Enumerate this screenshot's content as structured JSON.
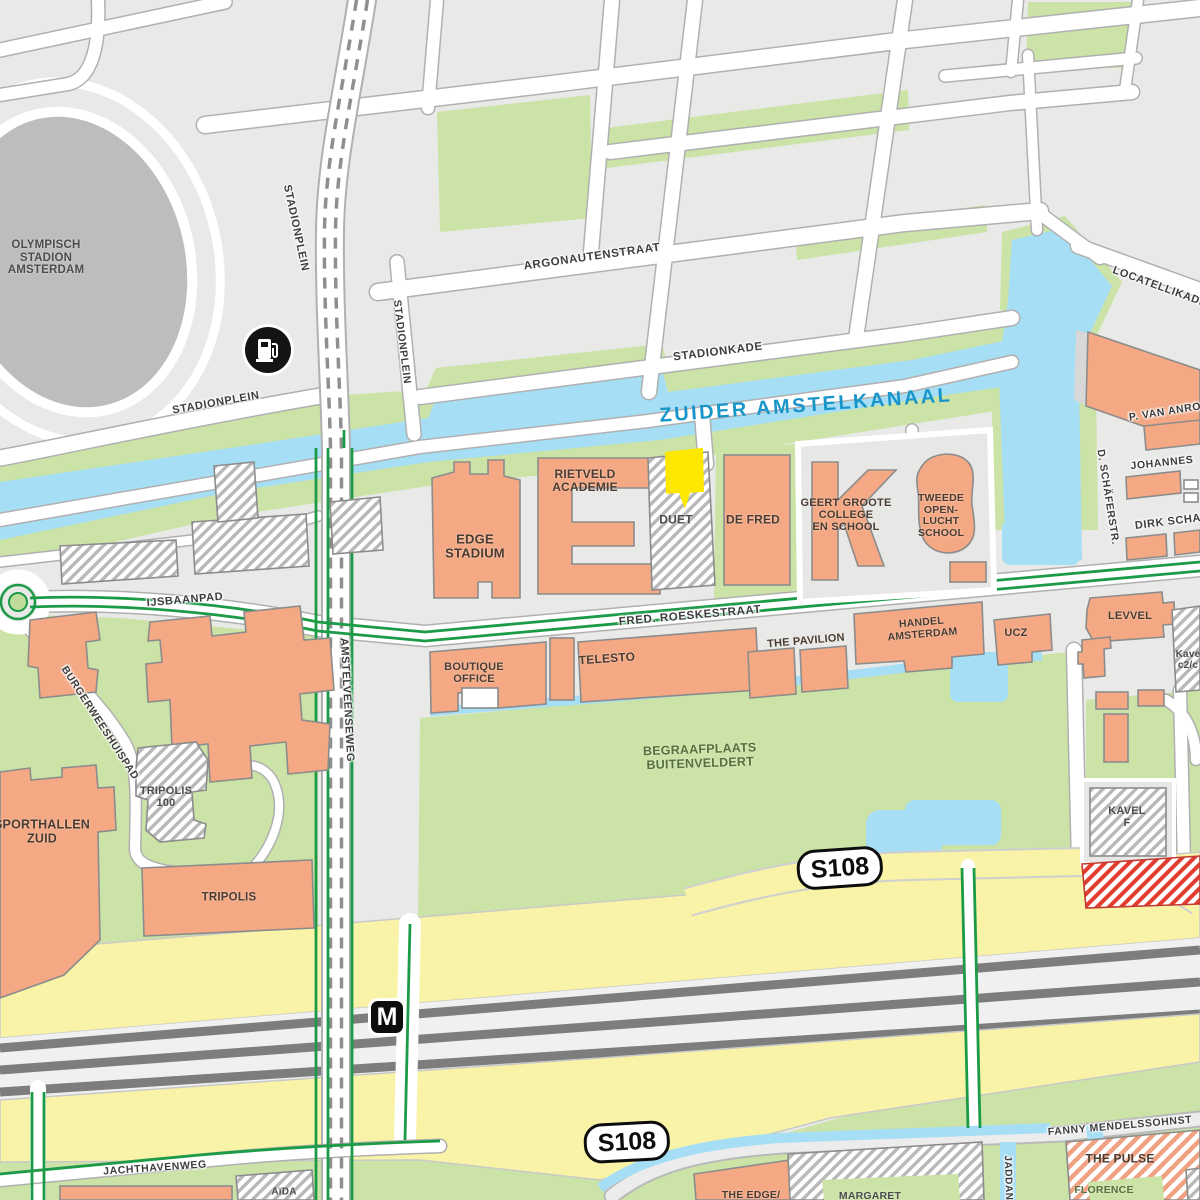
{
  "colors": {
    "block_gray": "#e9e9e7",
    "water": "#a6def5",
    "water_label": "#1895c9",
    "green": "#cbe3a6",
    "building_orange": "#f4a884",
    "hatch_stripe": "#b8b8b8",
    "red_hatch": "#e23d32",
    "road_yellow": "#f8f3a6",
    "rail_dark": "#7d7d7d",
    "route_green": "#1c9b47",
    "marker_yellow": "#ffe800",
    "stadium_gray": "#bdbdbd"
  },
  "street_labels": [
    {
      "id": "stadionplein-north",
      "text": "STADIONPLEIN",
      "x": 296,
      "y": 228,
      "rot": 78,
      "size": 11
    },
    {
      "id": "stadionplein-mid",
      "text": "STADIONPLEIN",
      "x": 402,
      "y": 342,
      "rot": 83,
      "size": 10.5
    },
    {
      "id": "stadionplein-curve",
      "text": "STADIONPLEIN",
      "x": 216,
      "y": 403,
      "rot": -10,
      "size": 11
    },
    {
      "id": "argonautenstraat",
      "text": "ARGONAUTENSTRAAT",
      "x": 592,
      "y": 257,
      "rot": -8,
      "size": 11.5
    },
    {
      "id": "stadionkade",
      "text": "STADIONKADE",
      "x": 718,
      "y": 352,
      "rot": -7,
      "size": 11.5
    },
    {
      "id": "zuider-amstelkanaal",
      "text": "ZUIDER AMSTELKANAAL",
      "x": 806,
      "y": 406,
      "rot": -4,
      "variant": "water"
    },
    {
      "id": "locatellikade",
      "text": "LOCATELLIKADE",
      "x": 1160,
      "y": 287,
      "rot": 20,
      "size": 11
    },
    {
      "id": "p-van-anrooy",
      "text": "P. VAN ANRO",
      "x": 1165,
      "y": 412,
      "rot": -9,
      "size": 10.5
    },
    {
      "id": "johannes",
      "text": "JOHANNES",
      "x": 1162,
      "y": 463,
      "rot": -6,
      "size": 10.5
    },
    {
      "id": "d-schaferstr",
      "text": "D. SCHÄFERSTR.",
      "x": 1108,
      "y": 497,
      "rot": 81,
      "size": 10.5
    },
    {
      "id": "dirk-scha",
      "text": "DIRK SCHA",
      "x": 1168,
      "y": 522,
      "rot": -7,
      "size": 11
    },
    {
      "id": "ijsbaanpad",
      "text": "IJSBAANPAD",
      "x": 185,
      "y": 600,
      "rot": -5,
      "size": 11
    },
    {
      "id": "fred-roeskestraat",
      "text": "FRED. ROESKESTRAAT",
      "x": 690,
      "y": 616,
      "rot": -5,
      "size": 11.5
    },
    {
      "id": "amstelveenseweg",
      "text": "AMSTELVEENSEWEG",
      "x": 347,
      "y": 700,
      "rot": 87,
      "size": 11
    },
    {
      "id": "burgerweeshuispad",
      "text": "BURGERWEESHUISPAD",
      "x": 100,
      "y": 723,
      "rot": 57,
      "size": 10.5
    },
    {
      "id": "jachthavenweg",
      "text": "JACHTHAVENWEG",
      "x": 155,
      "y": 1168,
      "rot": -4,
      "size": 10.5
    },
    {
      "id": "fanny-mendelssohnstraat",
      "text": "FANNY MENDELSSOHNST",
      "x": 1120,
      "y": 1126,
      "rot": -5,
      "size": 10.5
    },
    {
      "id": "jaddan",
      "text": "JADDAN",
      "x": 1008,
      "y": 1178,
      "rot": 88,
      "size": 10
    }
  ],
  "place_labels": [
    {
      "id": "olympisch-stadion",
      "lines": [
        "OLYMPISCH",
        "STADION",
        "AMSTERDAM"
      ],
      "x": 46,
      "y": 258,
      "size": 11.5,
      "variant": "muted"
    },
    {
      "id": "edge-stadium",
      "lines": [
        "EDGE",
        "STADIUM"
      ],
      "x": 475,
      "y": 547,
      "size": 13
    },
    {
      "id": "rietveld-academie",
      "lines": [
        "RIETVELD",
        "ACADEMIE"
      ],
      "x": 585,
      "y": 481,
      "size": 12
    },
    {
      "id": "duet",
      "lines": [
        "DUET"
      ],
      "x": 676,
      "y": 520,
      "size": 12,
      "variant": "muted"
    },
    {
      "id": "de-fred",
      "lines": [
        "DE FRED"
      ],
      "x": 753,
      "y": 520,
      "size": 12
    },
    {
      "id": "geert-groote-college",
      "lines": [
        "GEERT GROOTE",
        "COLLEGE",
        "EN SCHOOL"
      ],
      "x": 846,
      "y": 515,
      "size": 11
    },
    {
      "id": "tweede-openlucht-school",
      "lines": [
        "TWEEDE",
        "OPEN-",
        "LUCHT",
        "SCHOOL"
      ],
      "x": 941,
      "y": 516,
      "size": 10.5
    },
    {
      "id": "boutique-office",
      "lines": [
        "BOUTIQUE",
        "OFFICE"
      ],
      "x": 474,
      "y": 673,
      "size": 11
    },
    {
      "id": "telesto",
      "lines": [
        "TELESTO"
      ],
      "x": 607,
      "y": 659,
      "size": 12,
      "rot": -4
    },
    {
      "id": "the-pavilion",
      "lines": [
        "THE PAVILION"
      ],
      "x": 806,
      "y": 641,
      "size": 11,
      "rot": -5
    },
    {
      "id": "handel-amsterdam",
      "lines": [
        "HANDEL",
        "AMSTERDAM"
      ],
      "x": 922,
      "y": 629,
      "size": 10.5,
      "rot": -5
    },
    {
      "id": "ucz",
      "lines": [
        "UCZ"
      ],
      "x": 1016,
      "y": 633,
      "size": 11
    },
    {
      "id": "levvel",
      "lines": [
        "LEVVEL"
      ],
      "x": 1130,
      "y": 616,
      "size": 11
    },
    {
      "id": "kavel-c2",
      "lines": [
        "Kave",
        "c2/c"
      ],
      "x": 1188,
      "y": 660,
      "size": 10,
      "variant": "muted"
    },
    {
      "id": "begraafplaats-buitenveldert",
      "lines": [
        "BEGRAAFPLAATS",
        "BUITENVELDERT"
      ],
      "x": 700,
      "y": 757,
      "size": 12.5,
      "variant": "green",
      "rot": -2
    },
    {
      "id": "sporthallen-zuid",
      "lines": [
        "SPORTHALLEN",
        "ZUID"
      ],
      "x": 42,
      "y": 832,
      "size": 12.5
    },
    {
      "id": "tripolis-100",
      "lines": [
        "TRIPOLIS",
        "100"
      ],
      "x": 166,
      "y": 797,
      "size": 11,
      "variant": "muted"
    },
    {
      "id": "tripolis",
      "lines": [
        "TRIPOLIS"
      ],
      "x": 229,
      "y": 898,
      "size": 11.5
    },
    {
      "id": "kavel-f",
      "lines": [
        "KAVEL",
        "F"
      ],
      "x": 1127,
      "y": 817,
      "size": 11,
      "variant": "muted"
    },
    {
      "id": "aida",
      "lines": [
        "AïDA"
      ],
      "x": 284,
      "y": 1192,
      "size": 10,
      "variant": "muted"
    },
    {
      "id": "the-edge",
      "lines": [
        "THE EDGE/"
      ],
      "x": 751,
      "y": 1196,
      "size": 10.5
    },
    {
      "id": "margaret",
      "lines": [
        "MARGARET"
      ],
      "x": 870,
      "y": 1197,
      "size": 10.5,
      "variant": "muted"
    },
    {
      "id": "the-pulse",
      "lines": [
        "THE PULSE"
      ],
      "x": 1120,
      "y": 1159,
      "size": 12
    },
    {
      "id": "florence",
      "lines": [
        "FLORENCE"
      ],
      "x": 1104,
      "y": 1191,
      "size": 10.5,
      "variant": "green"
    }
  ],
  "markers": [
    {
      "id": "fuel-station",
      "type": "fuel",
      "x": 268,
      "y": 350
    },
    {
      "id": "metro-station",
      "type": "metro",
      "text": "M",
      "x": 387,
      "y": 1017
    },
    {
      "id": "route-shield-north",
      "type": "shield",
      "text": "S108",
      "x": 840,
      "y": 868,
      "rot": -4
    },
    {
      "id": "route-shield-south",
      "type": "shield",
      "text": "S108",
      "x": 627,
      "y": 1142,
      "rot": -3
    },
    {
      "id": "selected-location",
      "type": "pin",
      "x": 684,
      "y": 480
    }
  ]
}
